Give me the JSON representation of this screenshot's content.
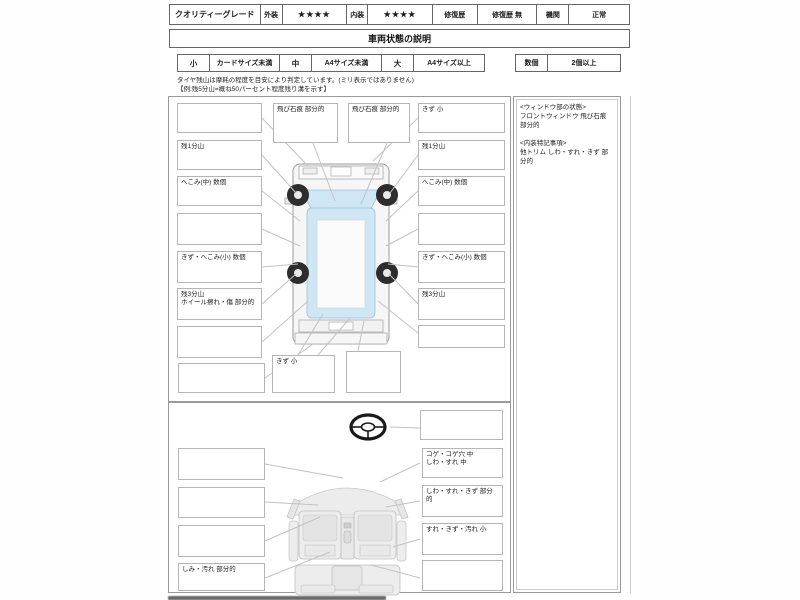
{
  "header": {
    "cells": [
      "クオリティーグレード",
      "外装",
      "★★★★",
      "内装",
      "★★★★",
      "修復歴",
      "修復歴 無",
      "機関",
      "正常"
    ]
  },
  "title": "車両状態の説明",
  "size_legend": {
    "size_cells": [
      "小",
      "カードサイズ未満",
      "中",
      "A4サイズ未満",
      "大",
      "A4サイズ以上"
    ],
    "count_cells": [
      "数個",
      "2個以上"
    ]
  },
  "tire_note": {
    "line1": "タイヤ残山は摩耗の程度を目安により判定しています。(ミリ表示ではありません)",
    "line2": "【例:残5分山=概ね50パーセント程度残り溝を示す】"
  },
  "exterior": {
    "top_boxes": [
      "飛び石痕 部分的",
      "飛び石痕 部分的"
    ],
    "left_boxes": [
      {
        "l1": "",
        "l2": ""
      },
      {
        "l1": "残1分山",
        "l2": ""
      },
      {
        "l1": "へこみ(中) 数個",
        "l2": ""
      },
      {
        "l1": "",
        "l2": ""
      },
      {
        "l1": "きず・へこみ(小) 数個",
        "l2": ""
      },
      {
        "l1": "残3分山",
        "l2": "ホイール擦れ・傷 部分的"
      },
      {
        "l1": "",
        "l2": ""
      }
    ],
    "right_boxes": [
      "きず 小",
      "残1分山",
      "へこみ(中) 数個",
      "",
      "きず・へこみ(小) 数個",
      "残3分山",
      ""
    ],
    "bottom_boxes": [
      "",
      "きず 小",
      ""
    ]
  },
  "side_panel": {
    "heading1": "<ウィンドウ部の状態>",
    "item1": "フロントウィンドウ 飛び石痕 部分的",
    "heading2": "<内装特記事項>",
    "item2": "他トリム しわ・すれ・きず 部分的"
  },
  "interior": {
    "left_boxes": [
      "",
      "",
      "",
      "しみ・汚れ 部分的"
    ],
    "right_boxes": [
      {
        "l1": "",
        "l2": ""
      },
      {
        "l1": "コゲ・コゲ穴 中",
        "l2": "しわ・すれ 中"
      },
      {
        "l1": "しわ・すれ・きず 部分的",
        "l2": ""
      },
      {
        "l1": "すれ・きず・汚れ 小",
        "l2": ""
      },
      {
        "l1": "",
        "l2": ""
      }
    ]
  },
  "colors": {
    "glass": "#cfe6f4",
    "glass_stroke": "#9cc0d8",
    "tire": "#2d2d2d",
    "callout": "#c2c2c2",
    "box_border": "#b5b5b5"
  }
}
